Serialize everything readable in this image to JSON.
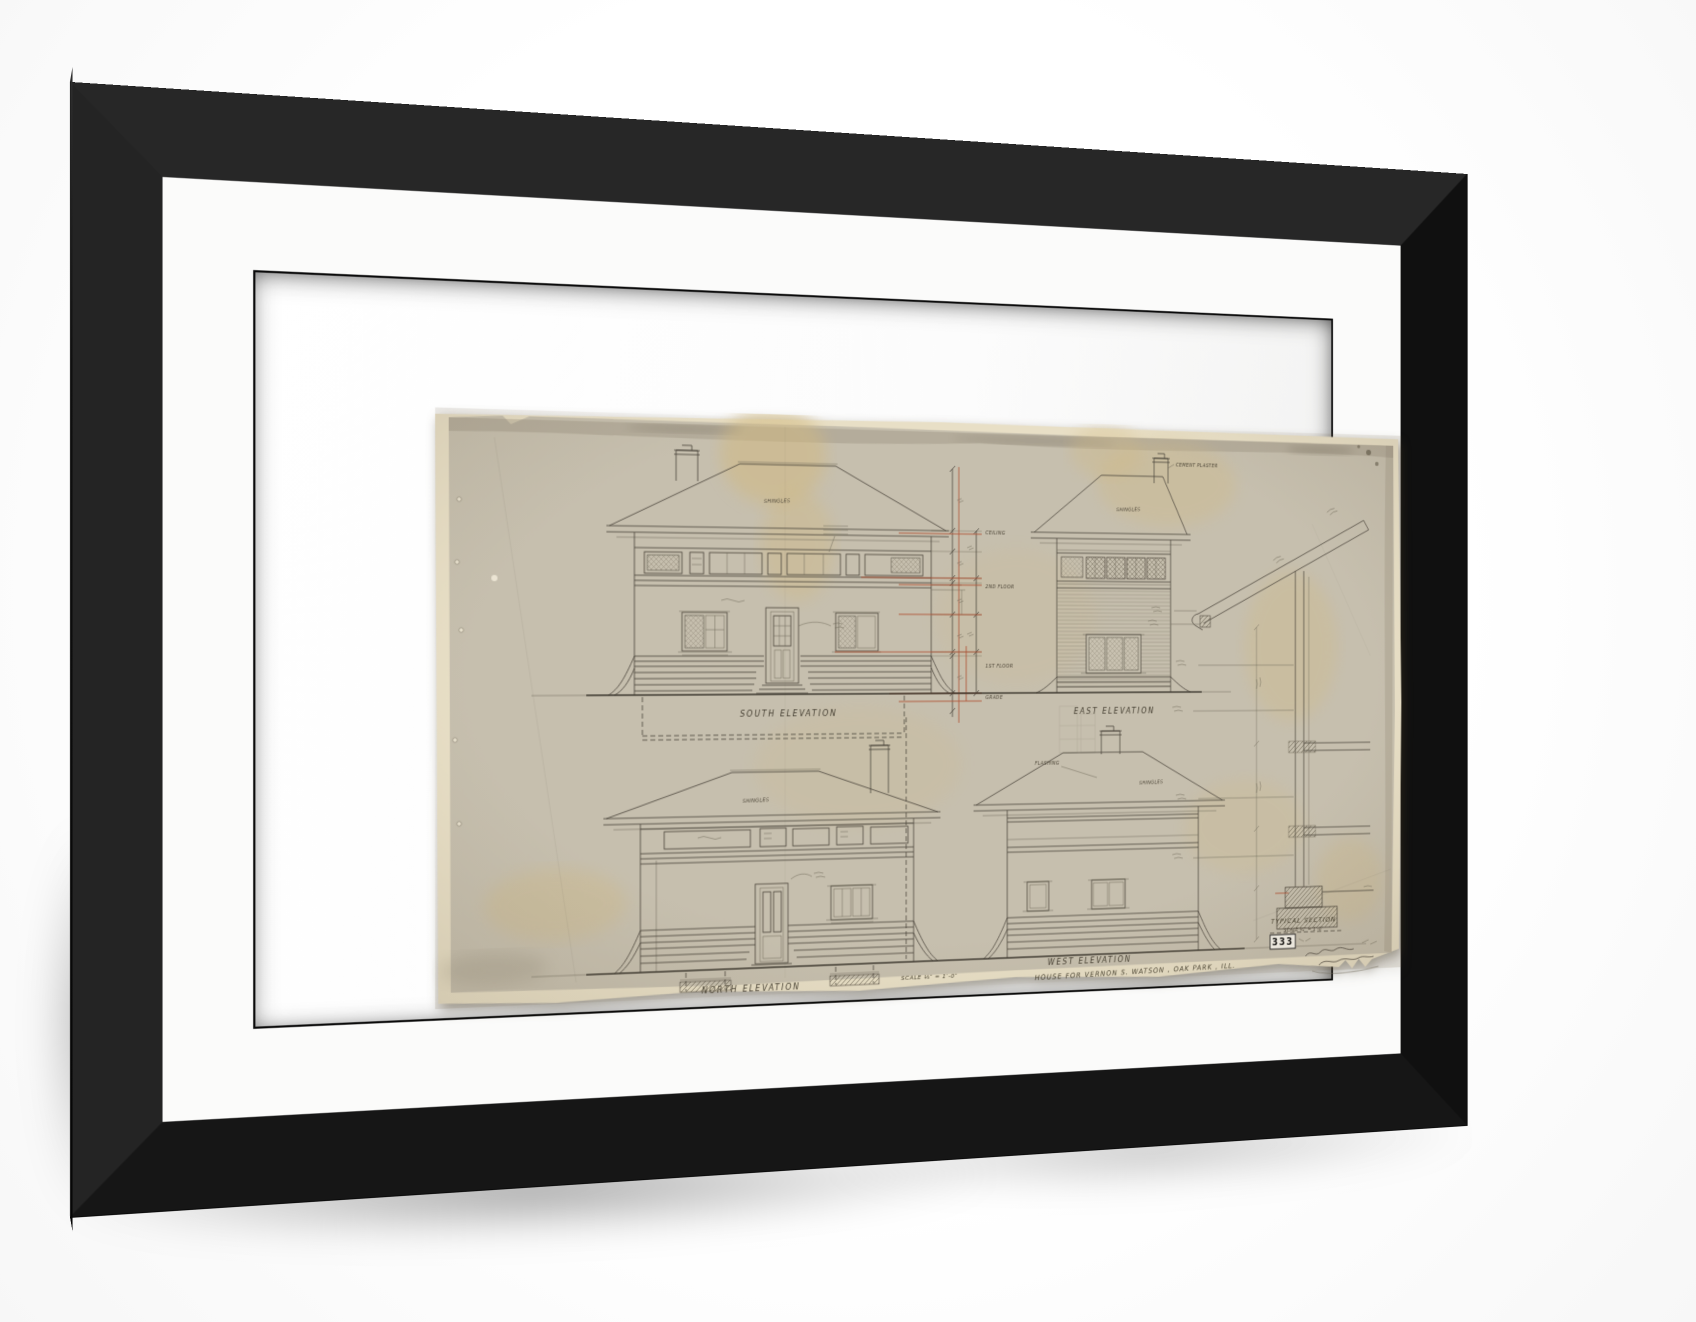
{
  "product": {
    "frame_color": "#1c1c1c",
    "frame_side_color": "#0a0a0a",
    "mat_color": "#fbfbfa"
  },
  "sheet": {
    "number": "333",
    "title": "HOUSE  FOR  VERNON  S. WATSON ,  OAK  PARK ,  ILL.",
    "scale_note": "SCALE ⅛″ = 1′-0″",
    "backing_color": "#e8dfc6",
    "sheet_color": "#c6bfae",
    "ink_color": "#4a443b",
    "redline_color": "#b05538",
    "elevations": {
      "south": "SOUTH   ELEVATION",
      "east": "EAST   ELEVATION",
      "north": "NORTH   ELEVATION",
      "west": "WEST   ELEVATION"
    },
    "section": {
      "label": "TYPICAL   SECTION",
      "scale_note": "SCALE ¾″ = 1′-0″"
    },
    "annotations": {
      "shingles": "SHINGLES",
      "flashing": "FLASHING",
      "cement_plaster": "CEMENT PLASTER",
      "ceiling": "CEILING",
      "second_floor": "2ND FLOOR",
      "first_floor": "1ST FLOOR",
      "grade": "GRADE"
    }
  }
}
